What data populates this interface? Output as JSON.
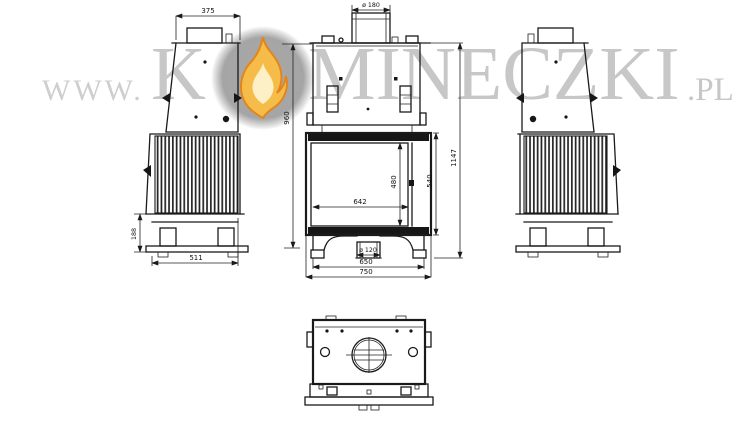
{
  "page": {
    "title": "Fireplace insert technical drawing"
  },
  "watermark": {
    "prefix": "WWW.",
    "part1": "K",
    "flame_icon": "flame-in-circle",
    "part2": "MINECZKI",
    "suffix": ".PL"
  },
  "views": {
    "side_left": {
      "label": "left side view",
      "dims": {
        "top_depth": "375",
        "base_height": "188",
        "depth": "511"
      }
    },
    "front": {
      "label": "front view",
      "dims": {
        "flue_diameter": "ø 180",
        "upper_height": "960",
        "total_height": "1147",
        "firebox_height": "540",
        "glass_height": "480",
        "glass_width": "642",
        "air_inlet_diameter": "ø 120",
        "base_width": "650",
        "total_width": "750"
      }
    },
    "side_right": {
      "label": "right side view"
    },
    "plan": {
      "label": "bottom plan view"
    }
  },
  "colors": {
    "line": "#1a1a1a",
    "watermark_gray": "#c7c7c7",
    "flame_circle_gray": "#a6a6a6",
    "flame_orange": "#f6bc4a",
    "flame_outline": "#e2861c",
    "flame_inner": "#fdf0c6"
  }
}
